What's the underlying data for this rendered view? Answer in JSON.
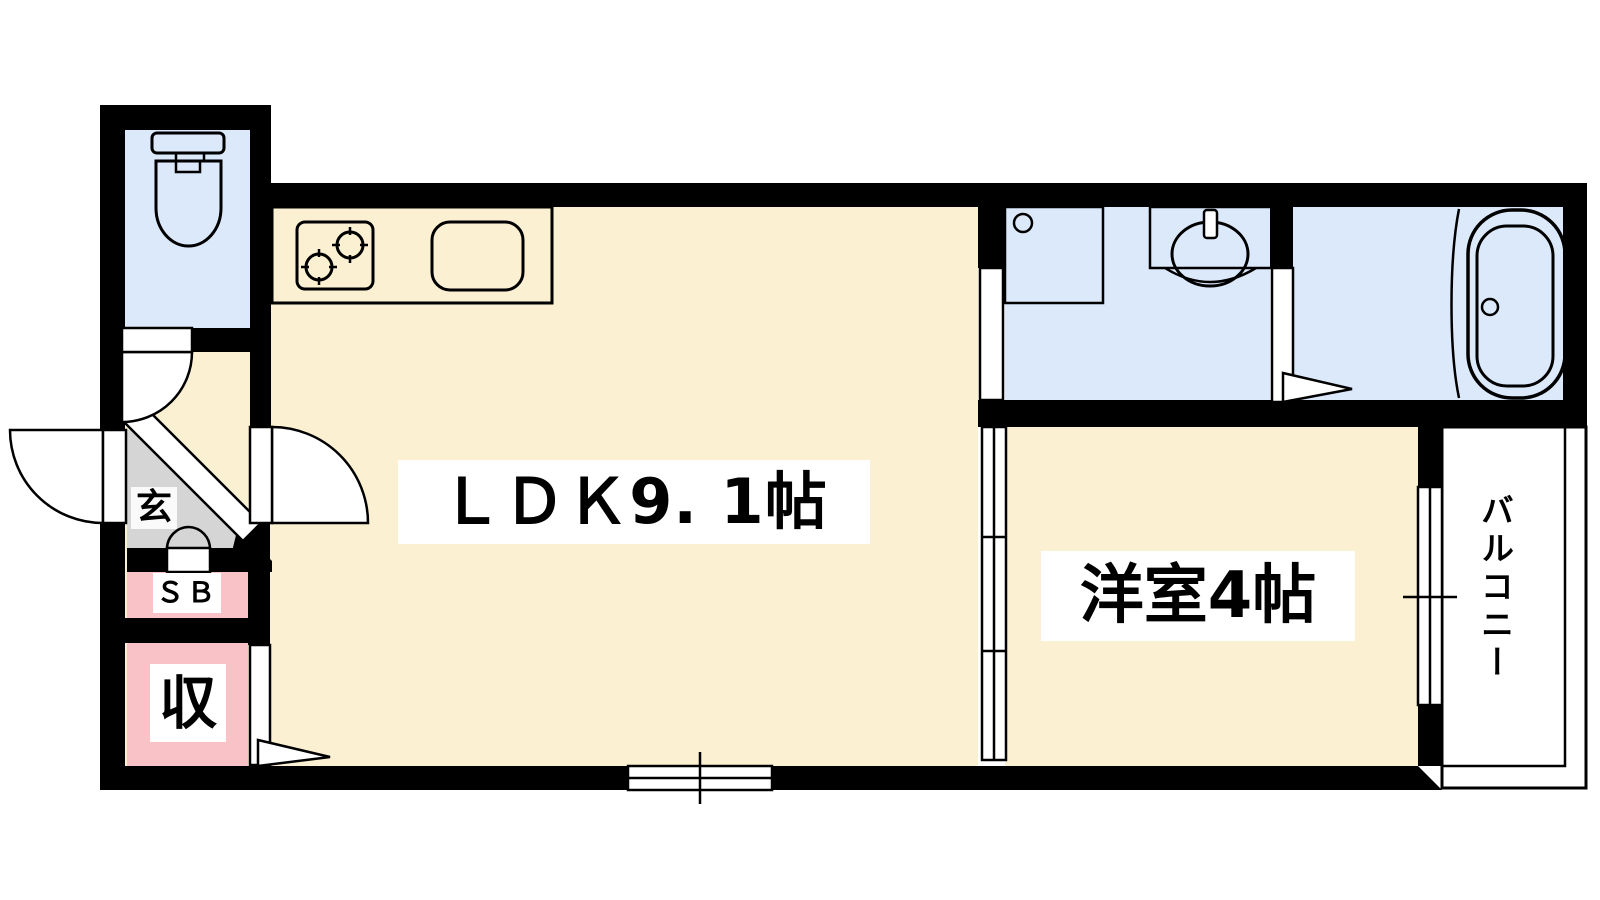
{
  "floorplan": {
    "labels": {
      "ldk": "ＬＤＫ9. 1帖",
      "western_room": "洋室4帖",
      "balcony": "バルコニー",
      "entrance": "玄",
      "shoe_box": "ＳＢ",
      "storage": "収"
    },
    "colors": {
      "floor_cream": "#FCF0D2",
      "water_blue": "#DCE9FA",
      "kitchen_purple": "#E7DAF2",
      "closet_pink": "#F9C2C7",
      "entry_gray": "#D5D5D5",
      "wall_black": "#000000"
    },
    "fixtures": [
      "toilet",
      "kitchen-stove",
      "kitchen-sink",
      "washing-machine-pan",
      "vanity-sink",
      "bathtub"
    ]
  }
}
